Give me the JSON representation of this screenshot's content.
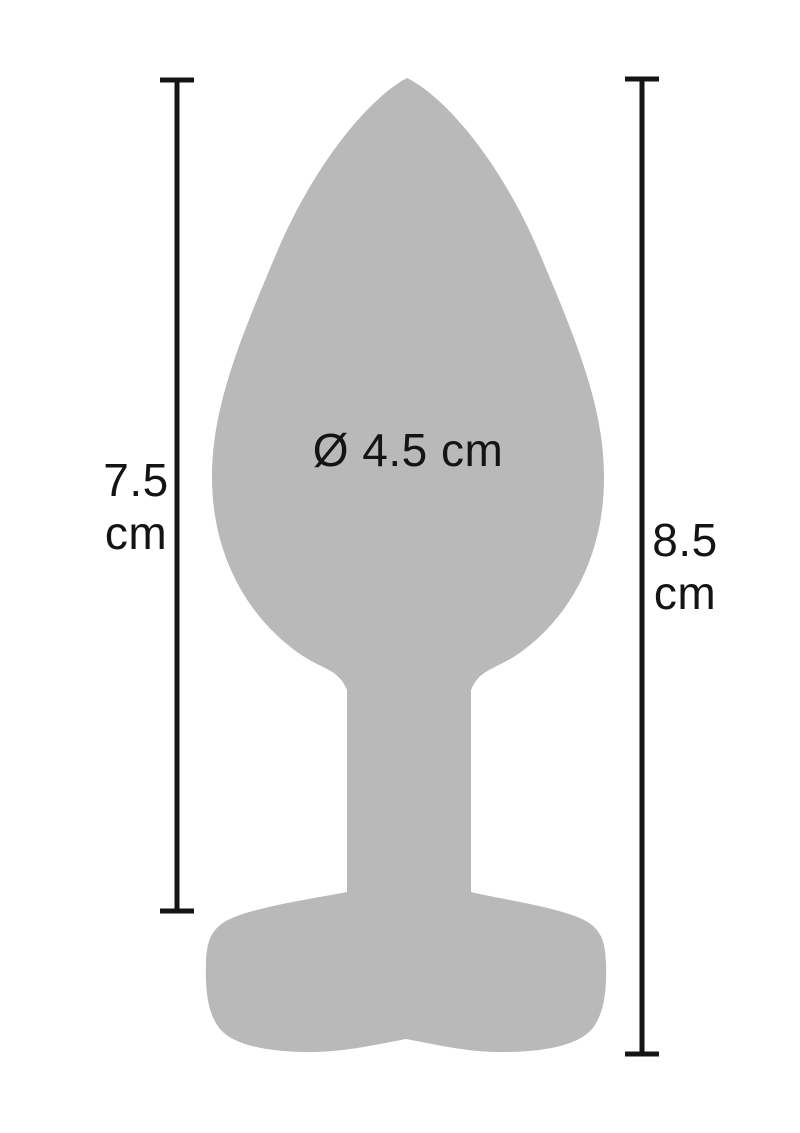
{
  "colors": {
    "shape": "#b9b9b9",
    "ink": "#141414",
    "background": "#ffffff"
  },
  "measurements": {
    "left": {
      "value": "7.5",
      "unit": "cm"
    },
    "right": {
      "value": "8.5",
      "unit": "cm"
    },
    "diameter": "Ø 4.5 cm"
  }
}
